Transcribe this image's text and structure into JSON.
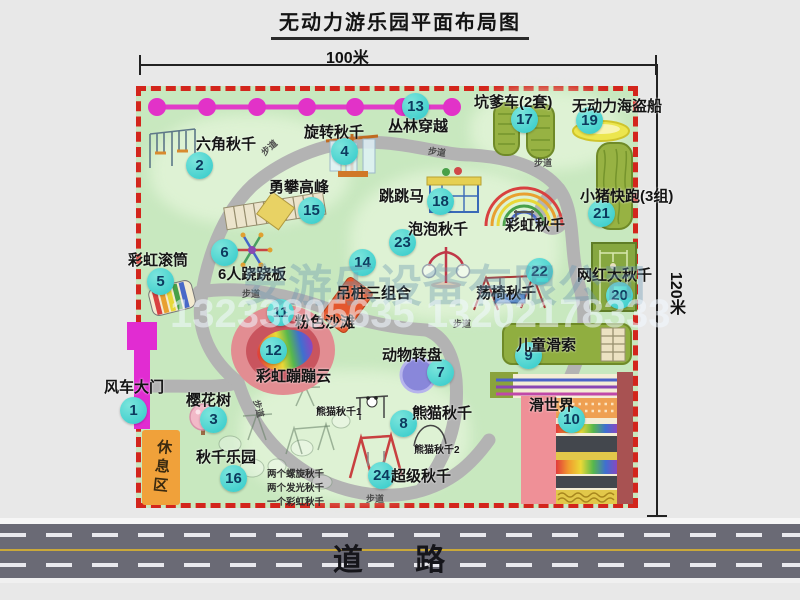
{
  "title": "无动力游乐园平面布局图",
  "dimensions": {
    "width_label": "100米",
    "height_label": "120米"
  },
  "watermark": {
    "company": "安游乐设备有限公司",
    "phone": "13233805635 13202178333"
  },
  "road": {
    "label": "道 路"
  },
  "rest_area_label": "休息区",
  "path_label_text": "步道",
  "path_labels": [
    {
      "x": 260,
      "y": 141,
      "r": -42
    },
    {
      "x": 428,
      "y": 145,
      "r": 8
    },
    {
      "x": 534,
      "y": 156,
      "r": 0
    },
    {
      "x": 242,
      "y": 287,
      "r": 0
    },
    {
      "x": 453,
      "y": 317,
      "r": 0
    },
    {
      "x": 250,
      "y": 402,
      "r": 75
    },
    {
      "x": 366,
      "y": 492,
      "r": 0
    }
  ],
  "sub_labels": {
    "rainbow_swing": "彩虹秋千",
    "panda_swing_1": "熊猫秋千1",
    "panda_swing_2": "熊猫秋千2"
  },
  "swing_park_notes": [
    "两个螺旋秋千",
    "两个发光秋千",
    "一个彩虹秋千"
  ],
  "attractions": [
    {
      "num": "1",
      "name": "风车大门",
      "badge": {
        "x": 133,
        "y": 410
      },
      "label": {
        "x": 104,
        "y": 376
      }
    },
    {
      "num": "2",
      "name": "六角秋千",
      "badge": {
        "x": 199,
        "y": 165
      },
      "label": {
        "x": 196,
        "y": 133
      }
    },
    {
      "num": "3",
      "name": "樱花树",
      "badge": {
        "x": 213,
        "y": 419
      },
      "label": {
        "x": 186,
        "y": 389
      }
    },
    {
      "num": "4",
      "name": "旋转秋千",
      "badge": {
        "x": 344,
        "y": 151
      },
      "label": {
        "x": 304,
        "y": 121
      }
    },
    {
      "num": "5",
      "name": "彩虹滚筒",
      "badge": {
        "x": 160,
        "y": 281
      },
      "label": {
        "x": 128,
        "y": 249
      }
    },
    {
      "num": "6",
      "name": "6人跷跷板",
      "badge": {
        "x": 224,
        "y": 252
      },
      "label": {
        "x": 218,
        "y": 263
      }
    },
    {
      "num": "7",
      "name": "动物转盘",
      "badge": {
        "x": 440,
        "y": 372
      },
      "label": {
        "x": 382,
        "y": 344
      }
    },
    {
      "num": "8",
      "name": "熊猫秋千",
      "badge": {
        "x": 403,
        "y": 423
      },
      "label": {
        "x": 412,
        "y": 402
      }
    },
    {
      "num": "9",
      "name": "儿童滑索",
      "badge": {
        "x": 528,
        "y": 355
      },
      "label": {
        "x": 516,
        "y": 334
      }
    },
    {
      "num": "10",
      "name": "滑世界",
      "badge": {
        "x": 571,
        "y": 419
      },
      "label": {
        "x": 529,
        "y": 394
      }
    },
    {
      "num": "11",
      "name": "粉色沙滩",
      "badge": {
        "x": 280,
        "y": 312
      },
      "label": {
        "x": 295,
        "y": 311
      }
    },
    {
      "num": "12",
      "name": "彩虹蹦蹦云",
      "badge": {
        "x": 273,
        "y": 350
      },
      "label": {
        "x": 256,
        "y": 365
      }
    },
    {
      "num": "13",
      "name": "丛林穿越",
      "badge": {
        "x": 415,
        "y": 106
      },
      "label": {
        "x": 388,
        "y": 115
      }
    },
    {
      "num": "14",
      "name": "吊桩三组合",
      "badge": {
        "x": 362,
        "y": 262
      },
      "label": {
        "x": 336,
        "y": 282
      }
    },
    {
      "num": "15",
      "name": "勇攀高峰",
      "badge": {
        "x": 311,
        "y": 210
      },
      "label": {
        "x": 269,
        "y": 176
      }
    },
    {
      "num": "16",
      "name": "秋千乐园",
      "badge": {
        "x": 233,
        "y": 478
      },
      "label": {
        "x": 196,
        "y": 446
      }
    },
    {
      "num": "17",
      "name": "坑爹车(2套)",
      "badge": {
        "x": 524,
        "y": 119
      },
      "label": {
        "x": 474,
        "y": 91
      }
    },
    {
      "num": "18",
      "name": "跳跳马",
      "badge": {
        "x": 440,
        "y": 201
      },
      "label": {
        "x": 379,
        "y": 185
      }
    },
    {
      "num": "19",
      "name": "无动力海盗船",
      "badge": {
        "x": 589,
        "y": 120
      },
      "label": {
        "x": 572,
        "y": 95
      }
    },
    {
      "num": "20",
      "name": "网红大秋千",
      "badge": {
        "x": 619,
        "y": 295
      },
      "label": {
        "x": 577,
        "y": 264
      }
    },
    {
      "num": "21",
      "name": "小猪快跑(3组)",
      "badge": {
        "x": 601,
        "y": 213
      },
      "label": {
        "x": 580,
        "y": 185
      }
    },
    {
      "num": "22",
      "name": "荡椅秋千",
      "badge": {
        "x": 539,
        "y": 271
      },
      "label": {
        "x": 476,
        "y": 282
      }
    },
    {
      "num": "23",
      "name": "泡泡秋千",
      "badge": {
        "x": 402,
        "y": 242
      },
      "label": {
        "x": 408,
        "y": 218
      }
    },
    {
      "num": "24",
      "name": "超级秋千",
      "badge": {
        "x": 381,
        "y": 475
      },
      "label": {
        "x": 391,
        "y": 465
      }
    }
  ]
}
